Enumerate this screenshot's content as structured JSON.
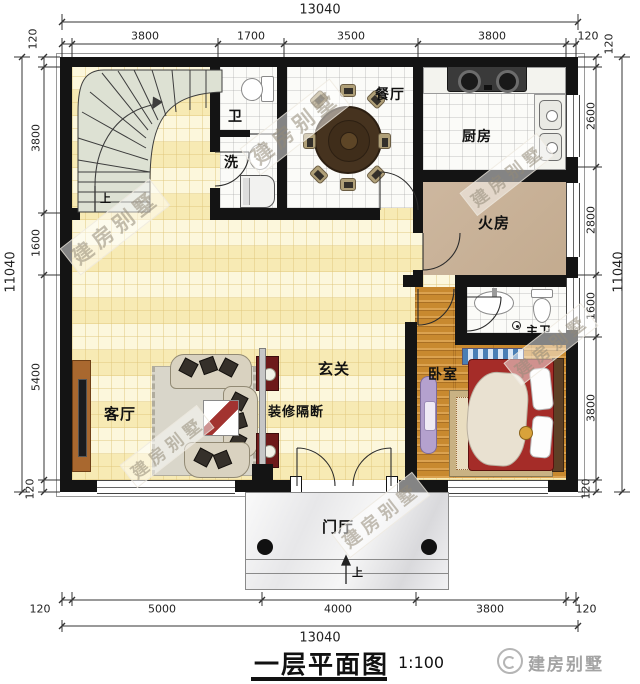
{
  "title": {
    "name": "一层平面图",
    "scale": "1:100"
  },
  "brand": {
    "name": "建房别墅",
    "icon": "circle-logo"
  },
  "watermark": {
    "text": "建房别墅"
  },
  "rooms": {
    "bath": "卫",
    "wash": "洗",
    "dining": "餐厅",
    "kitchen": "厨房",
    "fire_room": "火房",
    "master_bath": "主卫",
    "bedroom": "卧室",
    "hall": "玄关",
    "partition": "装修隔断",
    "living": "客厅",
    "porch": "门厅",
    "stair_up": "上",
    "porch_up": "上"
  },
  "dimensions": {
    "top": {
      "total": "13040",
      "edge": "120",
      "seg1": "3800",
      "seg2": "1700",
      "seg3": "3500",
      "seg4": "3800"
    },
    "bottom": {
      "total": "13040",
      "edge": "120",
      "seg1": "5000",
      "seg2": "4000",
      "seg3": "3800"
    },
    "left": {
      "total": "11040",
      "edge": "120",
      "seg1": "3800",
      "seg2": "1600",
      "seg3": "5400"
    },
    "right": {
      "total": "11040",
      "edge": "120",
      "seg1": "2600",
      "seg2": "2800",
      "seg3": "1600",
      "seg4": "3800"
    }
  },
  "colors": {
    "wall": "#141414",
    "cream_floor": "#f8f1cd",
    "wood_floor": "#c8892f",
    "fire_floor": "#c9b39b",
    "bed_blanket": "#a52c28",
    "side_table": "#6e1a1a",
    "partition_gray": "#c2c2c2"
  }
}
